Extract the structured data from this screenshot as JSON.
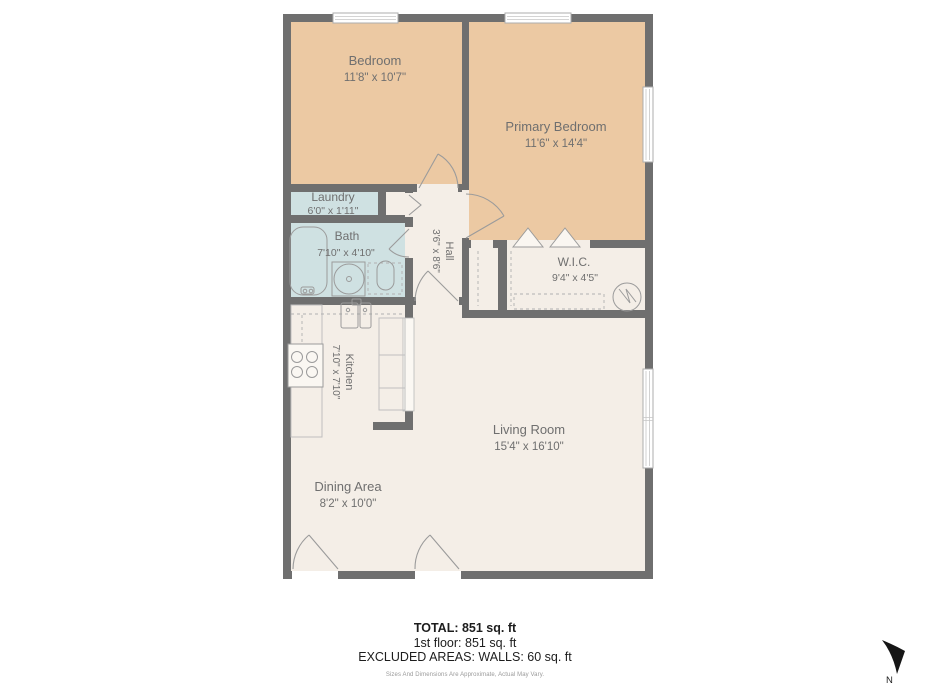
{
  "colors": {
    "wall": "#6f6f6f",
    "bedroom_fill": "#ecc9a3",
    "wet_fill": "#cfe1e2",
    "floor_fill": "#f4eee7",
    "label_text": "#6f6f6f",
    "footer_text": "#1d1d1d"
  },
  "rooms": [
    {
      "name": "Bedroom",
      "dims": "11'8\" x 10'7\""
    },
    {
      "name": "Primary Bedroom",
      "dims": "11'6\" x 14'4\""
    },
    {
      "name": "Laundry",
      "dims": "6'0\" x 1'11\""
    },
    {
      "name": "Bath",
      "dims": "7'10\" x 4'10\""
    },
    {
      "name": "Hall",
      "dims": "3'6\" x 8'6\""
    },
    {
      "name": "W.I.C.",
      "dims": "9'4\" x 4'5\""
    },
    {
      "name": "Kitchen",
      "dims": "7'10\" x 7'10\""
    },
    {
      "name": "Living Room",
      "dims": "15'4\" x 16'10\""
    },
    {
      "name": "Dining Area",
      "dims": "8'2\" x 10'0\""
    }
  ],
  "footer": {
    "total": "TOTAL: 851 sq. ft",
    "first_floor": "1st floor: 851 sq. ft",
    "excluded": "EXCLUDED AREAS: WALLS: 60 sq. ft",
    "disclaimer": "Sizes And Dimensions Are Approximate, Actual May Vary."
  },
  "compass": {
    "label": "N"
  }
}
